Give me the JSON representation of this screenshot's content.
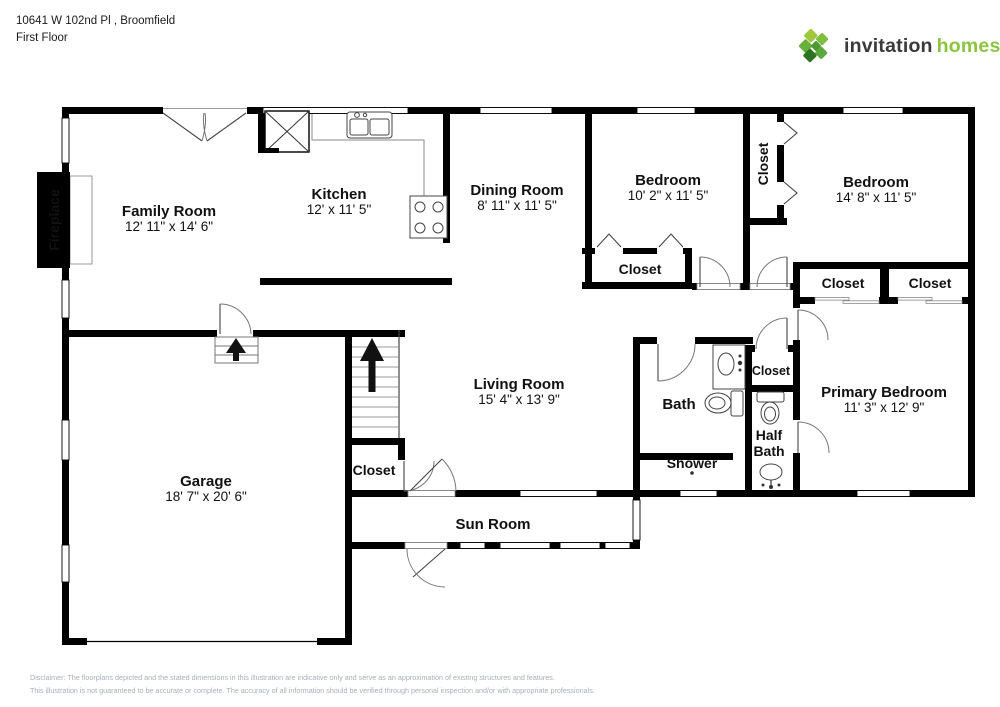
{
  "header": {
    "address": "10641 W 102nd Pl , Broomfield",
    "floor": "First Floor"
  },
  "logo": {
    "word1": "invitation",
    "word2": "homes",
    "icon": "invitation-homes-diamond-logo",
    "green": "#8bc53f",
    "dark": "#3a3a3c"
  },
  "rooms": {
    "family_room": {
      "name": "Family Room",
      "dims": "12' 11\" x 14' 6\""
    },
    "kitchen": {
      "name": "Kitchen",
      "dims": "12' x 11' 5\""
    },
    "dining_room": {
      "name": "Dining Room",
      "dims": "8' 11\" x 11' 5\""
    },
    "bedroom_1": {
      "name": "Bedroom",
      "dims": "10' 2\" x 11' 5\""
    },
    "bedroom_2": {
      "name": "Bedroom",
      "dims": "14' 8\" x 11' 5\""
    },
    "living_room": {
      "name": "Living Room",
      "dims": "15' 4\" x 13' 9\""
    },
    "primary_bedroom": {
      "name": "Primary Bedroom",
      "dims": "11' 3\" x 12' 9\""
    },
    "garage": {
      "name": "Garage",
      "dims": "18' 7\" x 20' 6\""
    },
    "sun_room": {
      "name": "Sun Room"
    },
    "bath": {
      "name": "Bath"
    },
    "half_bath": {
      "line1": "Half",
      "line2": "Bath"
    },
    "shower": {
      "name": "Shower"
    },
    "fireplace": {
      "name": "Fireplace"
    },
    "closet": {
      "name": "Closet"
    }
  },
  "colors": {
    "wall": "#000000",
    "logo_green": "#8bc53f",
    "logo_dark": "#3a3a3c",
    "disclaimer_gray": "#a9aeb9"
  },
  "disclaimer": {
    "line1": "Disclaimer: The floorplans depicted and the stated dimensions in this illustration are indicative only and serve as an approximation of existing structures and features.",
    "line2": "This illustration is not guaranteed to be accurate or complete. The accuracy of all information should be verified through personal inspection and/or with appropriate professionals."
  }
}
